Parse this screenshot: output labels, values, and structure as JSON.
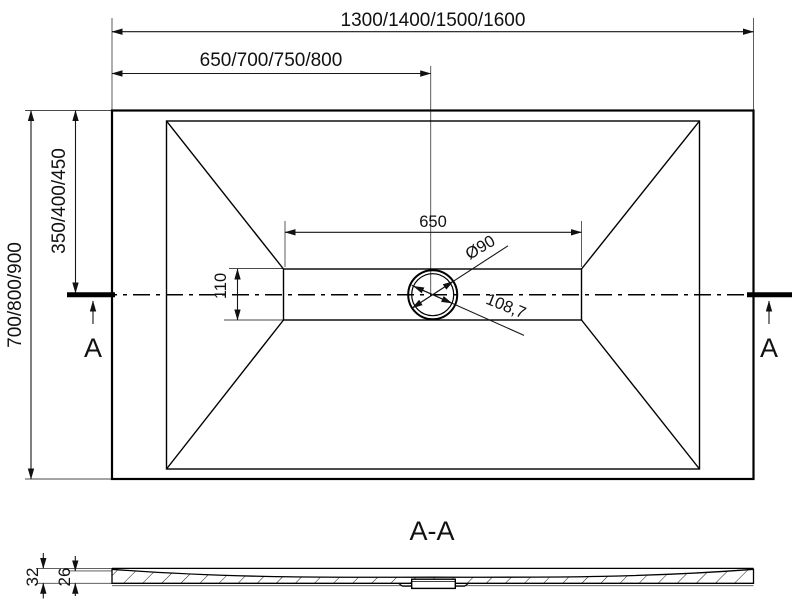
{
  "plan": {
    "dim_width_options": "1300/1400/1500/1600",
    "dim_half_width_options": "650/700/750/800",
    "dim_depth_options": "700/800/900",
    "dim_half_depth_options": "350/400/450",
    "dim_channel_length": "650",
    "dim_channel_width": "110",
    "dim_drain_diameter": "Ø90",
    "dim_drain_diagonal": "108,7",
    "section_marker_left": "A",
    "section_marker_right": "A"
  },
  "section": {
    "title": "A-A",
    "dim_total_thickness": "32",
    "dim_base_thickness": "26"
  },
  "colors": {
    "line": "#000000",
    "dimension": "#161616",
    "extension": "#4a4a4a",
    "background": "#ffffff"
  }
}
